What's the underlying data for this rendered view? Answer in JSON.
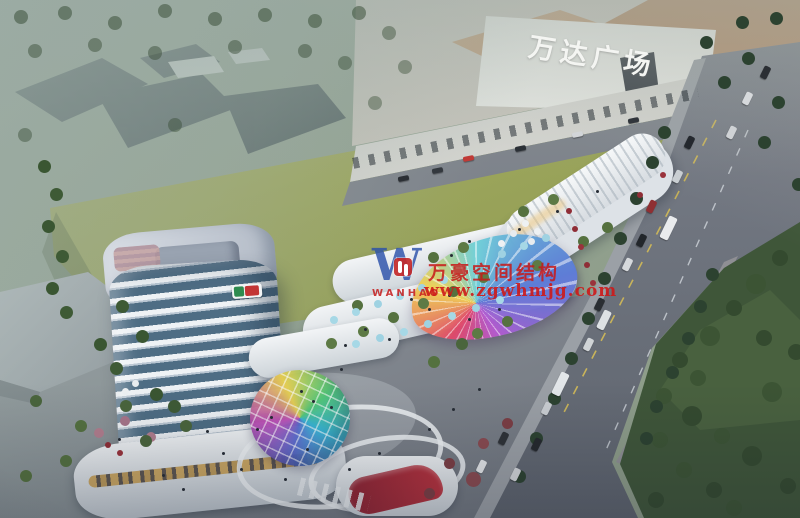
{
  "meta": {
    "type": "architectural-aerial-rendering",
    "description": "Bird's-eye dusk rendering of a mixed-use retail complex and tower beside Wanda Plaza, with avenue, lawn and park"
  },
  "labels": {
    "mall_sign": "万达广场"
  },
  "watermark": {
    "logo_letter": "W",
    "logo_text": "WANHAO",
    "line1": "万豪空间结构",
    "line2": "www.zgwhmjg.com",
    "color": "#c42222"
  },
  "palette": {
    "lawn": "#9aa35e",
    "haze": "#9caca6",
    "road": "#6f757f",
    "park": "#3f5639",
    "roof_tan": "#b28a66",
    "tower_band": "#eef2f5",
    "tower_glass": "#4e6d84",
    "canopy_rainbow": [
      "#e0486a",
      "#f0cf52",
      "#6fd0d8",
      "#5a7ad6",
      "#b45ad0"
    ]
  }
}
